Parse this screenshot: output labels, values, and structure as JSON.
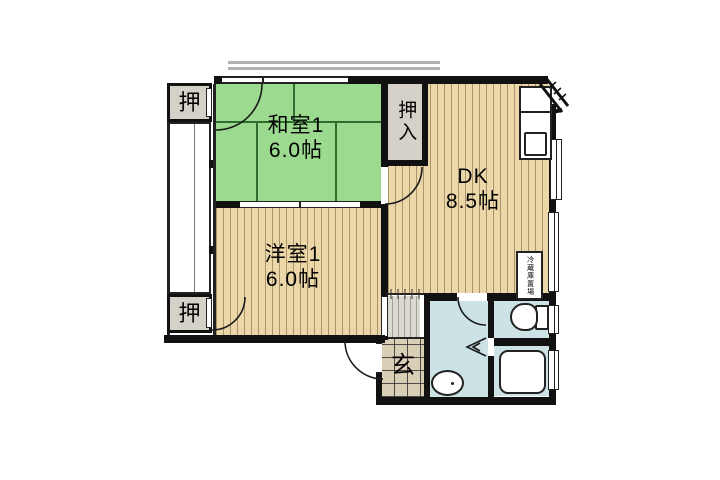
{
  "plan_name": "apartment-floor-plan",
  "rooms": {
    "washitsu1": {
      "name": "和室1",
      "size": "6.0帖"
    },
    "youshitsu1": {
      "name": "洋室1",
      "size": "6.0帖"
    },
    "dk": {
      "name": "DK",
      "size": "8.5帖"
    },
    "genkan": {
      "label": "玄"
    },
    "closet_top": {
      "label": "押"
    },
    "closet_bottom": {
      "label": "押"
    },
    "oshiire": {
      "label": "押入"
    },
    "fridge_space": {
      "label": "冷蔵庫置場"
    }
  },
  "colors": {
    "tatami": "#9cdb8f",
    "wood": "#ecd7a9",
    "water": "#cde2e4",
    "closet": "#d5d1c8",
    "tile": "#d8cfb6",
    "hall": "#dcd9d1",
    "wall": "#111111",
    "tatami_line": "#2f6e2f"
  }
}
